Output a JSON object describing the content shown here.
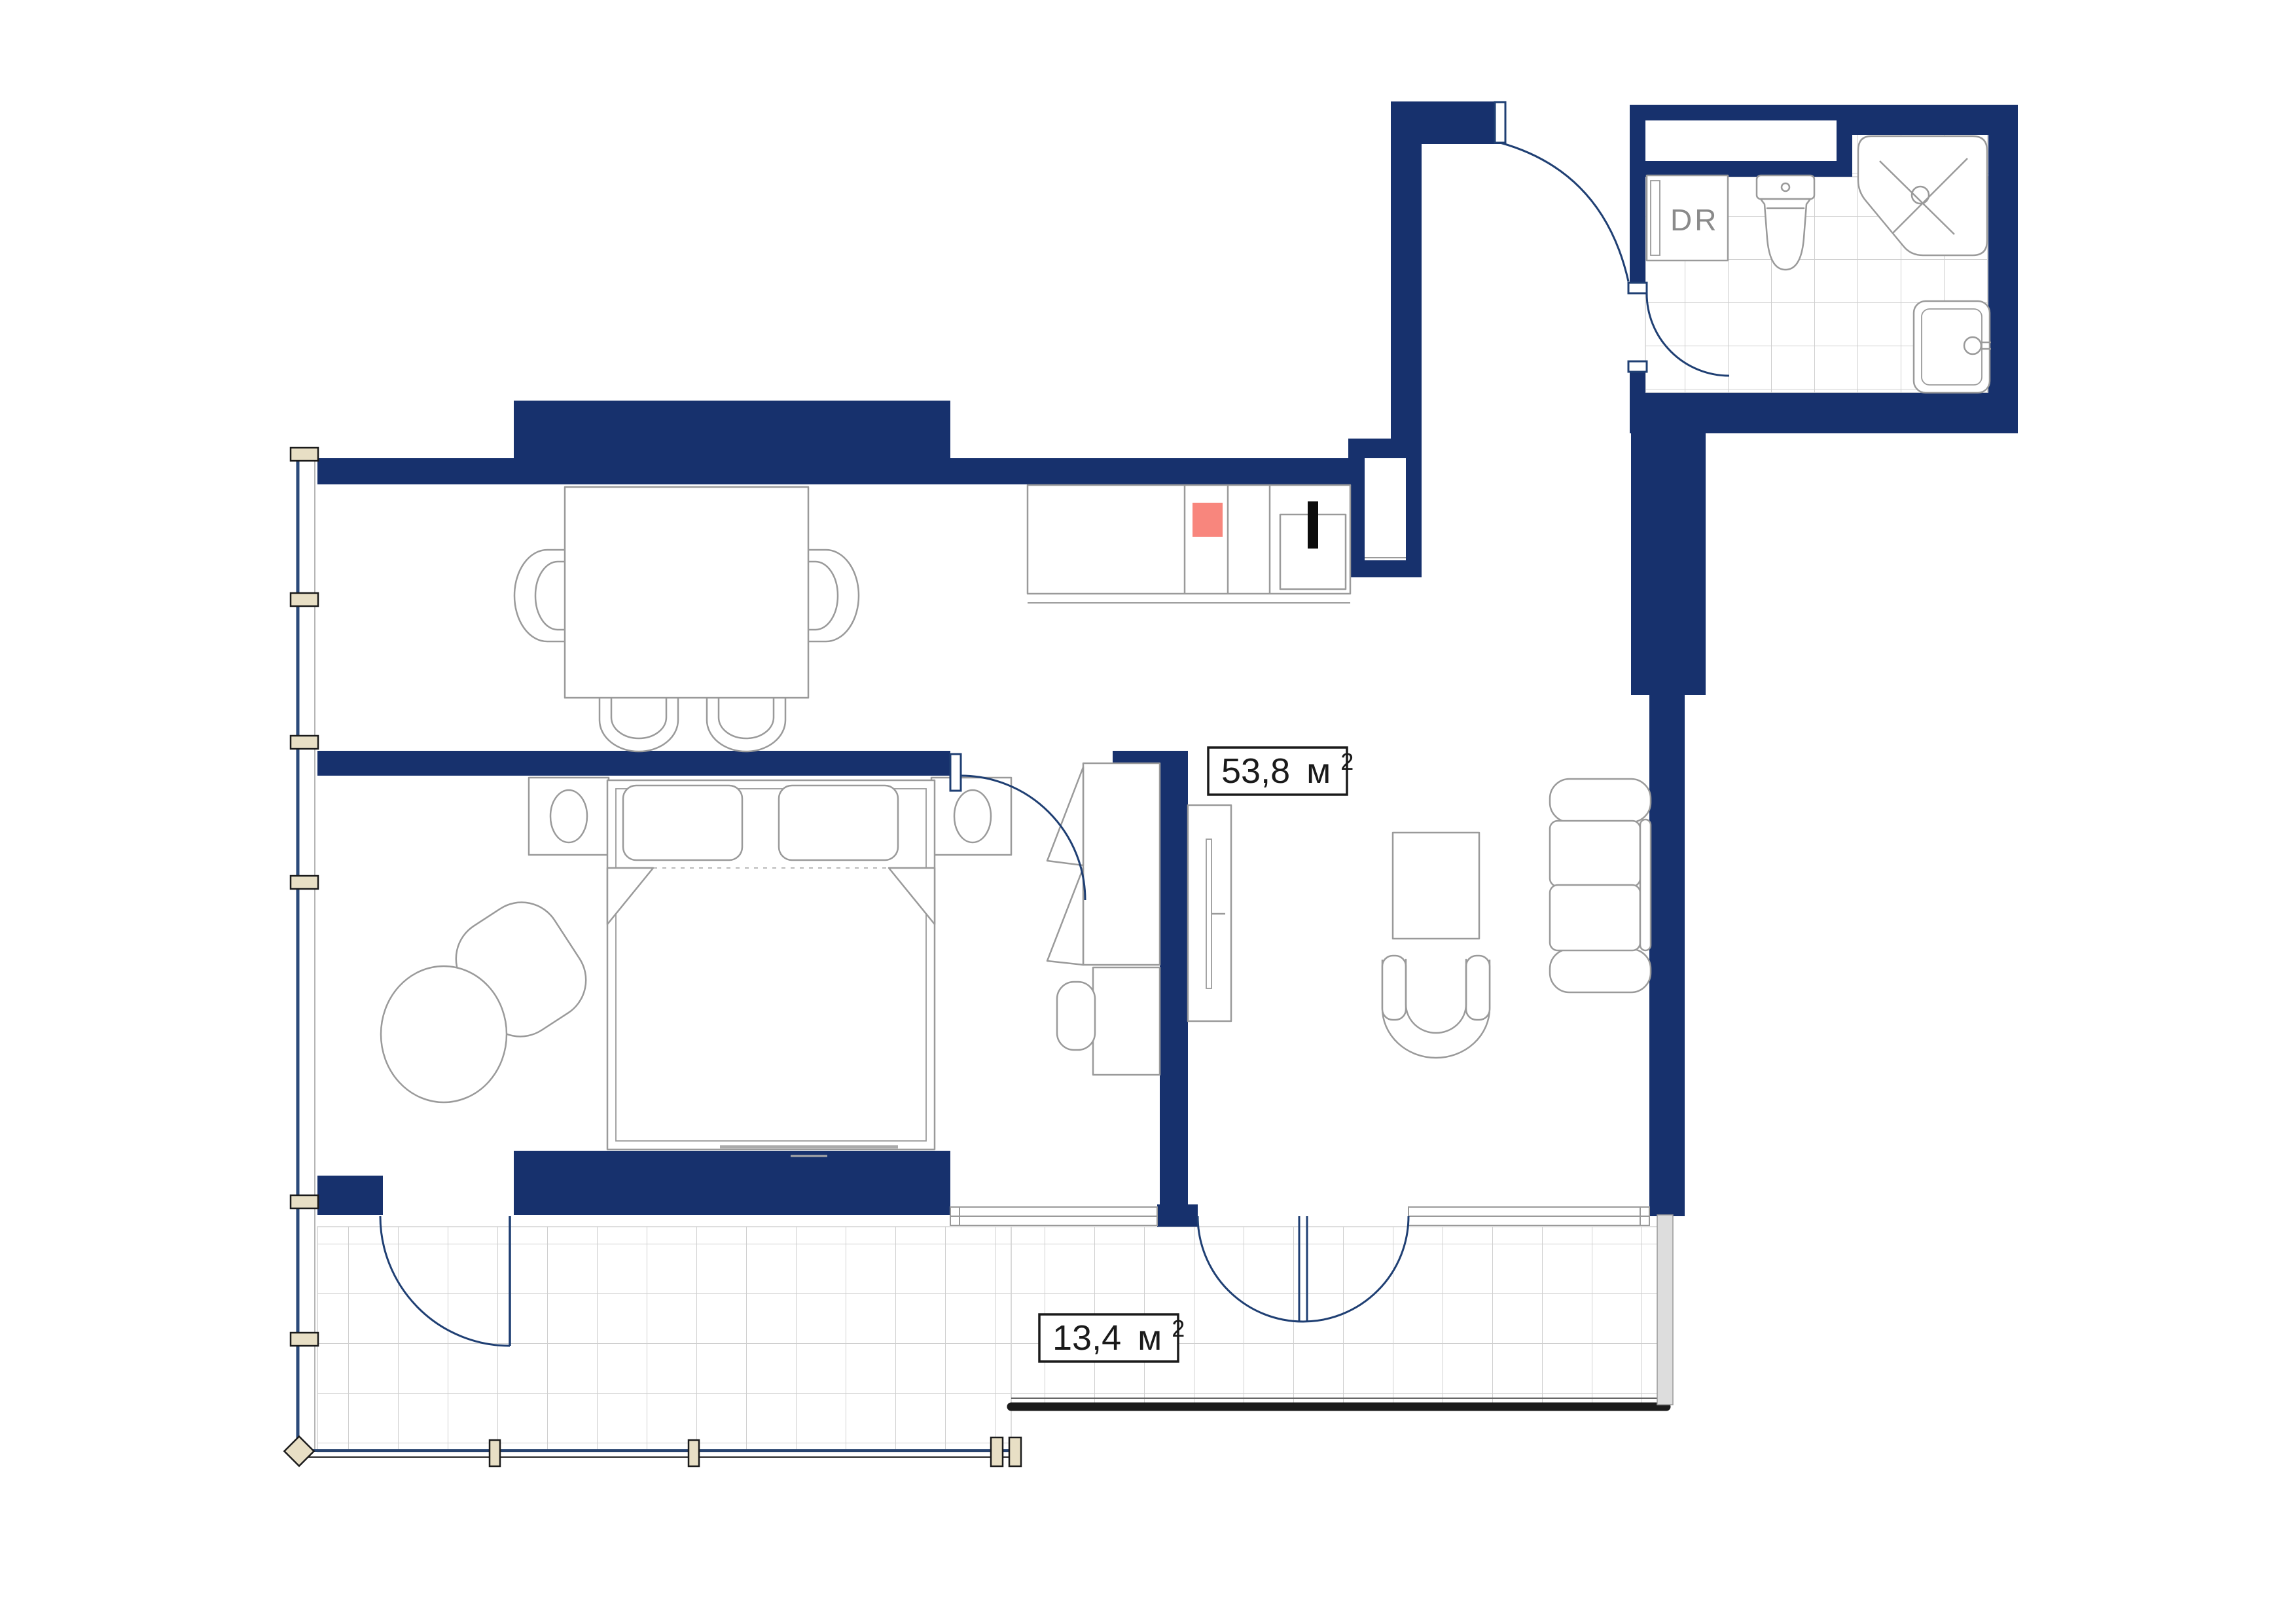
{
  "meta": {
    "kind": "apartment-floor-plan"
  },
  "colors": {
    "wall": "#17316d",
    "door": "#1f3f73",
    "furniture": "#9a9a9a",
    "tile": "#cfcfcf",
    "mullion": "#e8dfc5",
    "mullion_border": "#1a1a1a",
    "accent": "#f8867d",
    "railing": "#1c1c1c",
    "glass": "#2b4a7a",
    "label_border": "#1a1a1a",
    "label_text": "#1a1a1a",
    "closet_text": "#8a8a8a"
  },
  "labels": {
    "main_area": {
      "value": "53,8",
      "unit": "м",
      "sup": "2"
    },
    "balcony_area": {
      "value": "13,4",
      "unit": "м",
      "sup": "2"
    },
    "dryer_closet": {
      "text": "DR"
    }
  }
}
